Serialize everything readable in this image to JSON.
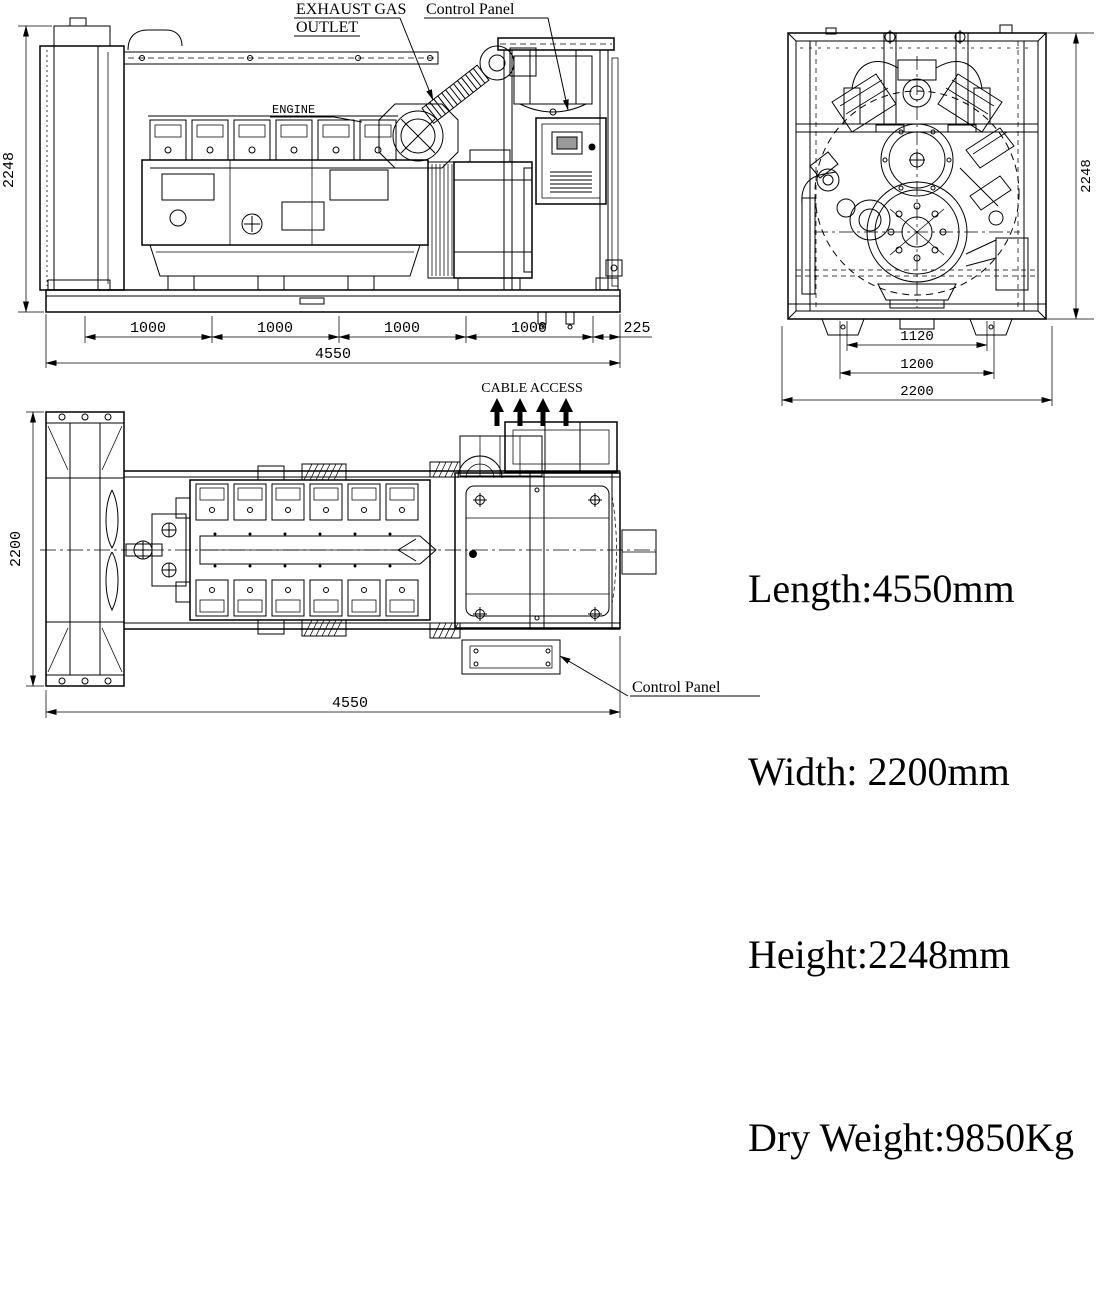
{
  "drawing": {
    "side_view": {
      "labels": {
        "exhaust_line1": "EXHAUST GAS",
        "exhaust_line2": "OUTLET",
        "control_panel": "Control Panel",
        "engine": "ENGINE"
      },
      "dimensions": {
        "height": "2248",
        "seg1": "1000",
        "seg2": "1000",
        "seg3": "1000",
        "seg4": "1000",
        "seg5": "225",
        "total_length": "4550"
      }
    },
    "end_view": {
      "dimensions": {
        "height": "2248",
        "inner_width": "1120",
        "base_width": "1200",
        "total_width": "2200"
      }
    },
    "top_view": {
      "labels": {
        "cable_access": "CABLE ACCESS",
        "control_panel": "Control Panel"
      },
      "dimensions": {
        "width": "2200",
        "total_length": "4550"
      }
    },
    "specs": {
      "length": "Length:4550mm",
      "width": "Width: 2200mm",
      "height": "Height:2248mm",
      "dry_weight": "Dry Weight:9850Kg"
    }
  },
  "colors": {
    "ink": "#000000",
    "background": "#ffffff"
  }
}
